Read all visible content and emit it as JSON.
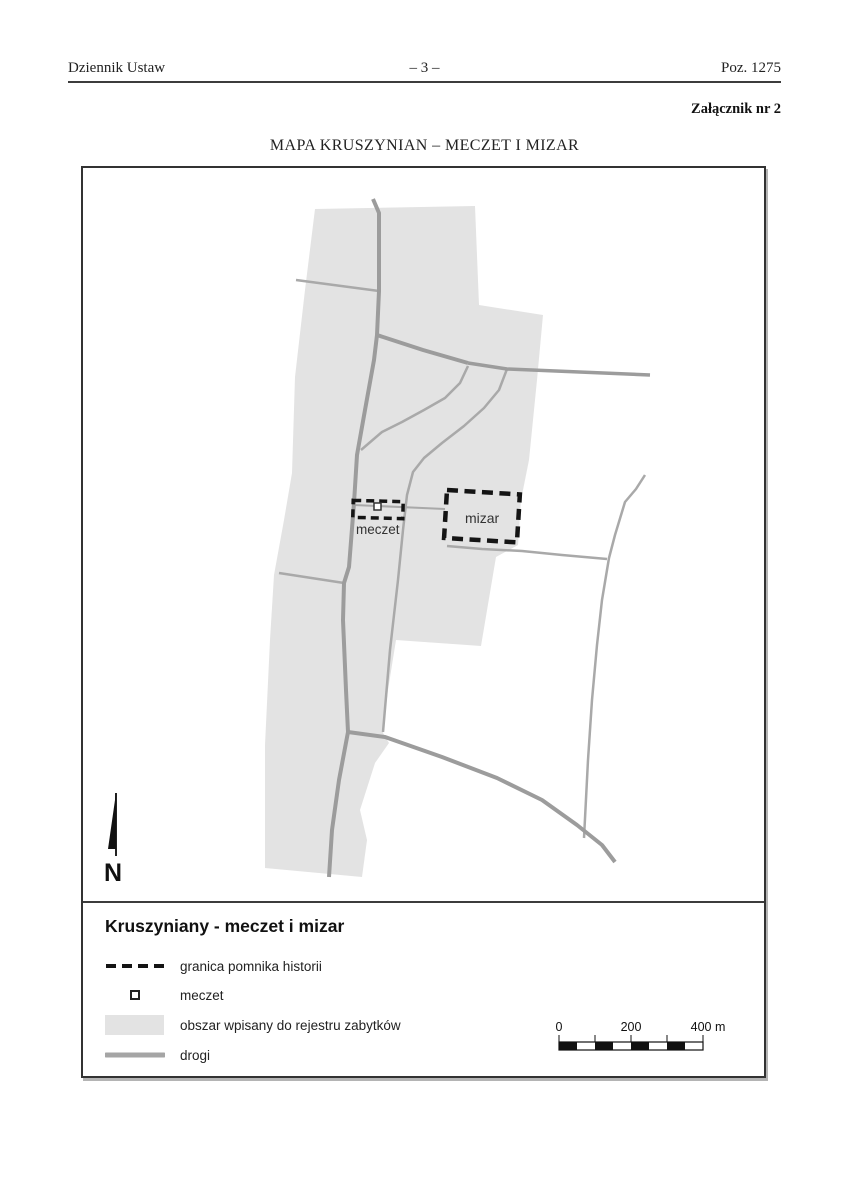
{
  "header": {
    "journal": "Dziennik Ustaw",
    "page_number": "– 3 –",
    "position": "Poz. 1275",
    "attachment": "Załącznik nr 2",
    "map_title": "MAPA KRUSZYNIAN – MECZET I MIZAR"
  },
  "map": {
    "labels": {
      "meczet": "meczet",
      "mizar": "mizar",
      "north": "N"
    }
  },
  "legend": {
    "title": "Kruszyniany - meczet i mizar",
    "items": [
      {
        "label": "granica pomnika historii"
      },
      {
        "label": "meczet"
      },
      {
        "label": "obszar wpisany do rejestru zabytków"
      },
      {
        "label": "drogi"
      }
    ]
  },
  "scale_bar": {
    "labels": [
      "0",
      "200",
      "400 m"
    ]
  },
  "colors": {
    "protected_area": "#e3e3e3",
    "road_main": "#9c9c9c",
    "road_minor": "#a9a9a9",
    "monument_border": "#141414",
    "road_legend": "#a5a5a5"
  }
}
